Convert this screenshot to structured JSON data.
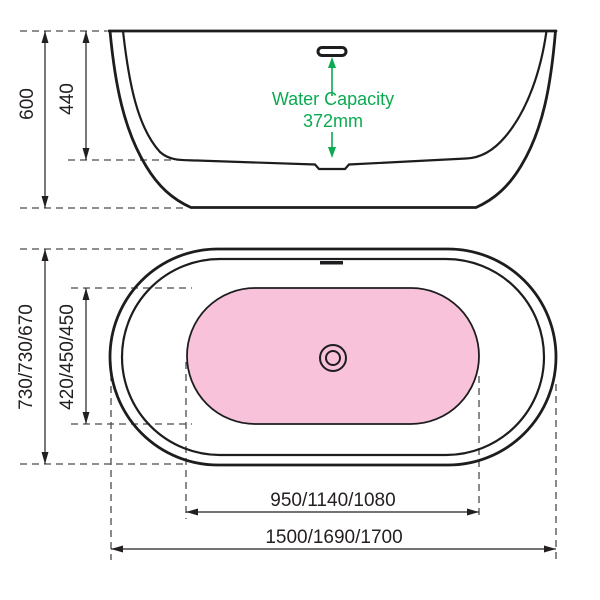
{
  "diagram_title": "Freestanding bathtub dimension drawing",
  "colors": {
    "pink_basin": "#f8c3da",
    "green_annotation": "#0caa51",
    "line": "#231f20",
    "extension_dash": "#4b4b4d"
  },
  "side_view": {
    "total_height": "600",
    "inner_depth": "440",
    "water_capacity": {
      "label": "Water Capacity",
      "value": "372mm"
    }
  },
  "plan_view": {
    "overall_width": "730/730/670",
    "inner_width": "420/450/450",
    "inner_length": "950/1140/1080",
    "overall_length": "1500/1690/1700"
  }
}
